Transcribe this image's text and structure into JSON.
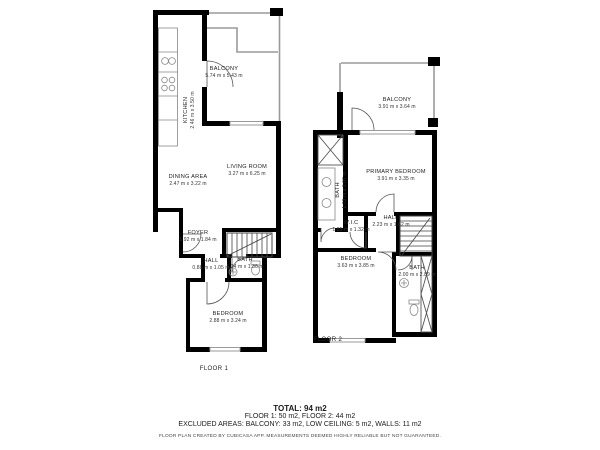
{
  "floor1": {
    "caption": "FLOOR 1",
    "rooms": {
      "balcony": {
        "name": "BALCONY",
        "dims": "5.74 m x 5.43 m"
      },
      "kitchen": {
        "name": "KITCHEN",
        "dims": "2.46 m x 3.50 m"
      },
      "dining": {
        "name": "DINING AREA",
        "dims": "2.47 m x 3.22 m"
      },
      "living": {
        "name": "LIVING ROOM",
        "dims": "3.27 m x 6.25 m"
      },
      "foyer": {
        "name": "FOYER",
        "dims": "1.92 m x 1.84 m"
      },
      "hall": {
        "name": "HALL",
        "dims": "0.88 m x 1.05 m"
      },
      "bath": {
        "name": "BATH",
        "dims": "1.24 m x 1.36 m"
      },
      "bedroom": {
        "name": "BEDROOM",
        "dims": "2.88 m x 3.24 m"
      }
    }
  },
  "floor2": {
    "caption": "FLOOR 2",
    "rooms": {
      "balcony": {
        "name": "BALCONY",
        "dims": "3.91 m x 3.64 m"
      },
      "bath_top": {
        "name": "BATH",
        "dims": "1.73 m x 3.07 m"
      },
      "primary": {
        "name": "PRIMARY BEDROOM",
        "dims": "3.91 m x 3.35 m"
      },
      "wic": {
        "name": "W.I.C",
        "dims": "1.85 m x 1.32 m"
      },
      "hall": {
        "name": "HALL",
        "dims": "2.23 m x 1.82 m"
      },
      "bedroom": {
        "name": "BEDROOM",
        "dims": "3.63 m x 3.85 m"
      },
      "bath": {
        "name": "BATH",
        "dims": "2.00 m x 2.89 m"
      }
    }
  },
  "summary": {
    "total": "TOTAL: 94 m2",
    "floors": "FLOOR 1: 50 m2, FLOOR 2: 44 m2",
    "excluded": "EXCLUDED AREAS: BALCONY: 33 m2, LOW CEILING: 5 m2, WALLS: 11 m2",
    "disclaimer": "FLOOR PLAN CREATED BY CUBICASA APP. MEASUREMENTS DEEMED HIGHLY RELIABLE BUT NOT GUARANTEED."
  },
  "colors": {
    "wall": "#000000",
    "balcony_rail": "#9a9a9a",
    "fixture": "#777777",
    "text": "#1a1a1a",
    "background": "#ffffff"
  }
}
